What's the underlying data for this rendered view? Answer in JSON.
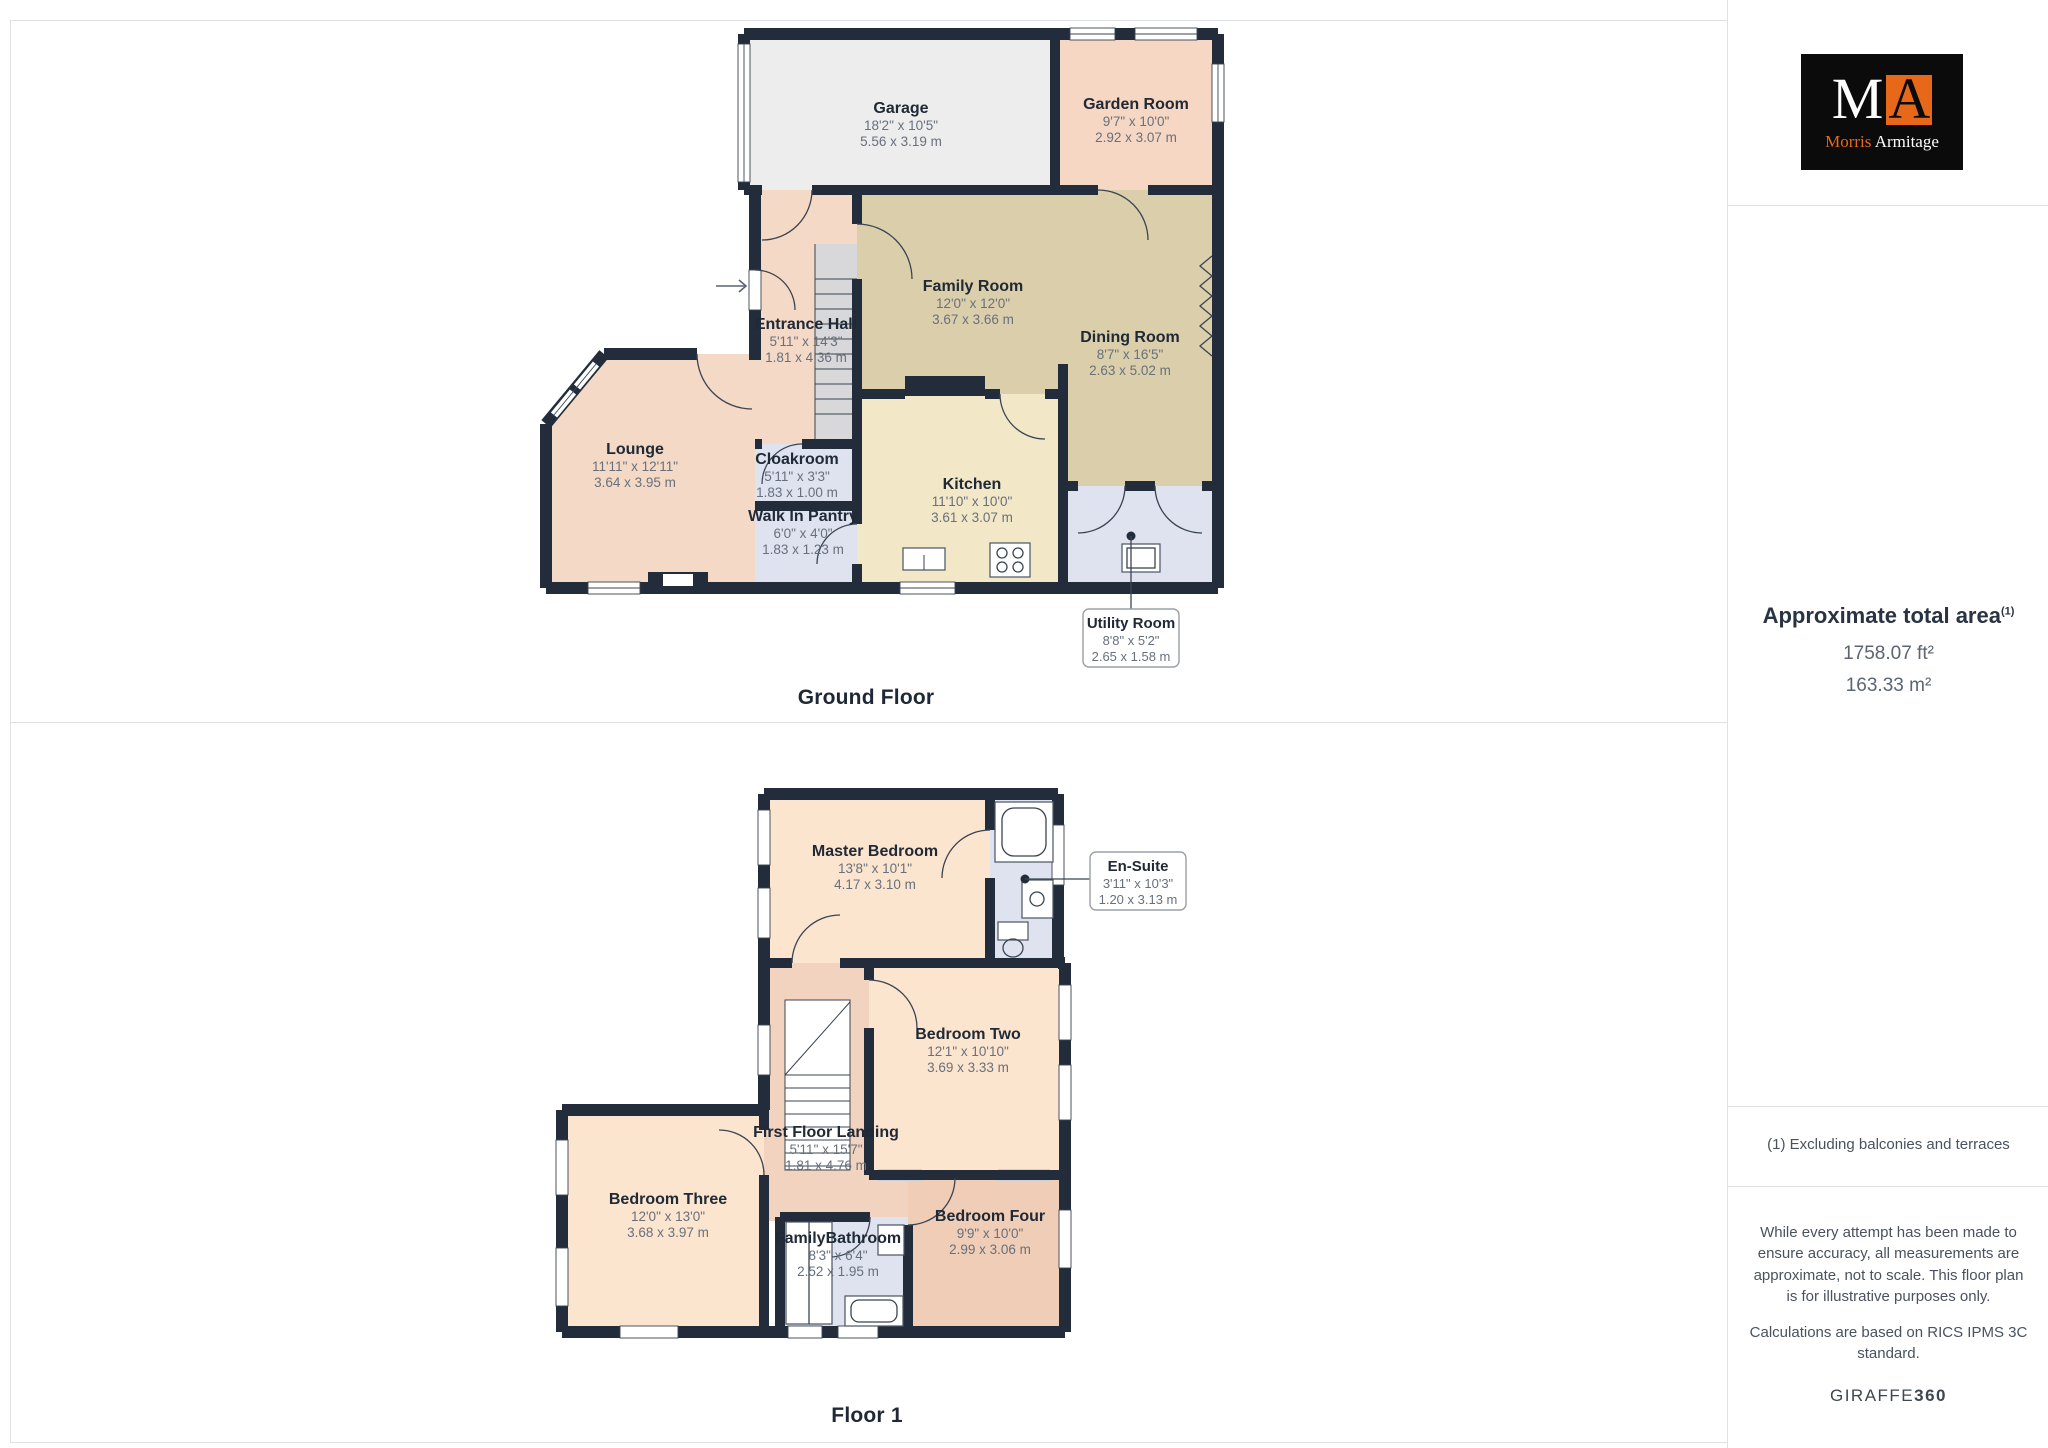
{
  "branding": {
    "logo_m": "M",
    "logo_a": "A",
    "logo_name_first": "Morris",
    "logo_name_last": "Armitage",
    "giraffe_brand": "GIRAFFE",
    "giraffe_360": "360"
  },
  "sidebar": {
    "total_area_title": "Approximate total area",
    "total_area_marker": "(1)",
    "total_area_ft": "1758.07 ft²",
    "total_area_m": "163.33 m²",
    "footnote": "(1) Excluding balconies and terraces",
    "disclaimer_1": "While every attempt has been made to ensure accuracy, all measurements are approximate, not to scale. This floor plan is for illustrative purposes only.",
    "disclaimer_2": "Calculations are based on RICS IPMS 3C standard."
  },
  "colors": {
    "brand_orange": "#e8681a",
    "wall": "#222c3a",
    "room_peach": "#f4d9c6",
    "room_tan": "#dbcfab",
    "room_cream": "#f2e8c8",
    "room_blue": "#dee3ef",
    "room_gray": "#ededee"
  },
  "floors": [
    {
      "label": "Ground Floor",
      "rooms": [
        {
          "name": "Garage",
          "imperial": "18'2\" x 10'5\"",
          "metric": "5.56 x 3.19 m"
        },
        {
          "name": "Garden Room",
          "imperial": "9'7\" x 10'0\"",
          "metric": "2.92 x 3.07 m"
        },
        {
          "name": "Family Room",
          "imperial": "12'0\" x 12'0\"",
          "metric": "3.67 x 3.66 m"
        },
        {
          "name": "Dining Room",
          "imperial": "8'7\" x 16'5\"",
          "metric": "2.63 x 5.02 m"
        },
        {
          "name": "Entrance Hall",
          "imperial": "5'11\" x 14'3\"",
          "metric": "1.81 x 4.36 m"
        },
        {
          "name": "Lounge",
          "imperial": "11'11\" x 12'11\"",
          "metric": "3.64 x 3.95 m"
        },
        {
          "name": "Cloakroom",
          "imperial": "5'11\" x 3'3\"",
          "metric": "1.83 x 1.00 m"
        },
        {
          "name": "Walk In Pantry",
          "imperial": "6'0\" x 4'0\"",
          "metric": "1.83 x 1.23 m"
        },
        {
          "name": "Kitchen",
          "imperial": "11'10\" x 10'0\"",
          "metric": "3.61 x 3.07 m"
        },
        {
          "name": "Utility Room",
          "imperial": "8'8\" x 5'2\"",
          "metric": "2.65 x 1.58 m"
        }
      ]
    },
    {
      "label": "Floor 1",
      "rooms": [
        {
          "name": "Master Bedroom",
          "imperial": "13'8\" x 10'1\"",
          "metric": "4.17 x 3.10 m"
        },
        {
          "name": "En-Suite",
          "imperial": "3'11\" x 10'3\"",
          "metric": "1.20 x 3.13 m"
        },
        {
          "name": "Bedroom Two",
          "imperial": "12'1\" x 10'10\"",
          "metric": "3.69 x 3.33 m"
        },
        {
          "name": "First Floor Landing",
          "imperial": "5'11\" x 15'7\"",
          "metric": "1.81 x 4.76 m"
        },
        {
          "name": "Bedroom Three",
          "imperial": "12'0\" x 13'0\"",
          "metric": "3.68 x 3.97 m"
        },
        {
          "name": "FamilyBathroom",
          "imperial": "8'3\" x 6'4\"",
          "metric": "2.52 x 1.95 m"
        },
        {
          "name": "Bedroom Four",
          "imperial": "9'9\" x 10'0\"",
          "metric": "2.99 x 3.06 m"
        }
      ]
    }
  ]
}
